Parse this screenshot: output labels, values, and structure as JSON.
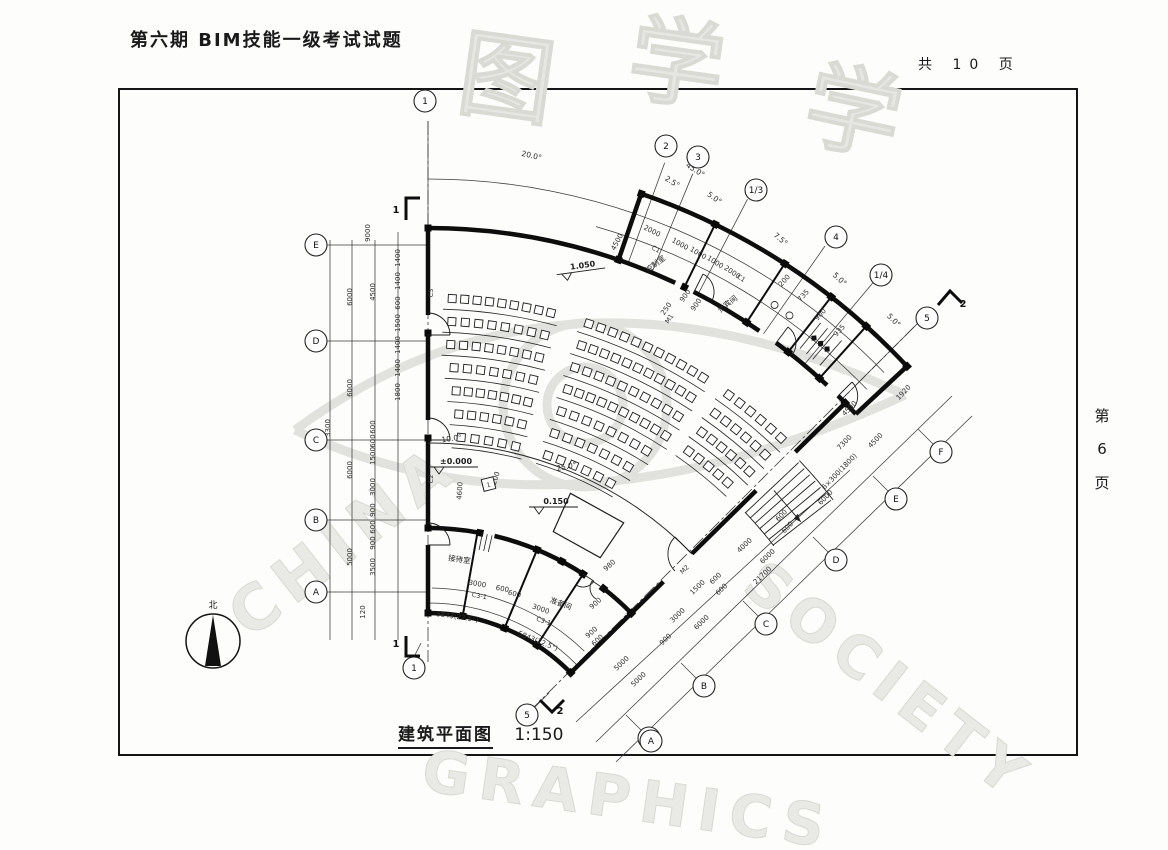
{
  "page": {
    "title": "第六期 BIM技能一级考试试题",
    "total_pages": "共 10 页",
    "side_page": [
      "第",
      "6",
      "页"
    ],
    "caption": "建筑平面图",
    "scale": "1:150"
  },
  "compass": {
    "label": "北"
  },
  "watermark": {
    "cn": [
      "图",
      "学",
      "学"
    ],
    "en": [
      "CHINA",
      "GRAPHICS",
      "SOCIETY"
    ]
  },
  "plan": {
    "axis_bubbles": [
      {
        "t": "1",
        "x": 425,
        "y": 101
      },
      {
        "t": "2",
        "x": 666,
        "y": 146
      },
      {
        "t": "3",
        "x": 698,
        "y": 157
      },
      {
        "t": "1/3",
        "x": 756,
        "y": 190
      },
      {
        "t": "4",
        "x": 836,
        "y": 237
      },
      {
        "t": "1/4",
        "x": 881,
        "y": 275
      },
      {
        "t": "5",
        "x": 927,
        "y": 318
      },
      {
        "t": "E",
        "x": 316,
        "y": 245
      },
      {
        "t": "D",
        "x": 316,
        "y": 341
      },
      {
        "t": "C",
        "x": 316,
        "y": 440
      },
      {
        "t": "B",
        "x": 316,
        "y": 520
      },
      {
        "t": "A",
        "x": 316,
        "y": 592
      },
      {
        "t": "F",
        "x": 941,
        "y": 452
      },
      {
        "t": "E",
        "x": 896,
        "y": 499
      },
      {
        "t": "D",
        "x": 836,
        "y": 560
      },
      {
        "t": "C",
        "x": 766,
        "y": 624
      },
      {
        "t": "B",
        "x": 704,
        "y": 686
      },
      {
        "t": "A",
        "x": 649,
        "y": 738
      },
      {
        "t": "5",
        "x": 527,
        "y": 715
      },
      {
        "t": "1",
        "x": 414,
        "y": 668
      },
      {
        "t": "A",
        "x": 651,
        "y": 741
      }
    ],
    "angle_dims": [
      {
        "t": "20.0°",
        "x": 531,
        "y": 158,
        "r": 13
      },
      {
        "t": "2.5°",
        "x": 671,
        "y": 184,
        "r": 32
      },
      {
        "t": "45.0°",
        "x": 694,
        "y": 172,
        "r": 33
      },
      {
        "t": "5.0°",
        "x": 713,
        "y": 200,
        "r": 35
      },
      {
        "t": "7.5°",
        "x": 779,
        "y": 241,
        "r": 40
      },
      {
        "t": "5.0°",
        "x": 838,
        "y": 281,
        "r": 43
      },
      {
        "t": "5.0°",
        "x": 892,
        "y": 322,
        "r": 45
      },
      {
        "t": "10.0°",
        "x": 452,
        "y": 441,
        "r": -8
      },
      {
        "t": "25.0°",
        "x": 567,
        "y": 469,
        "r": -12
      }
    ],
    "dim_labels": [
      {
        "t": "9000",
        "x": 370,
        "y": 233,
        "r": -90
      },
      {
        "t": "6000",
        "x": 352,
        "y": 297,
        "r": -90
      },
      {
        "t": "4500",
        "x": 375,
        "y": 292,
        "r": -90
      },
      {
        "t": "1400",
        "x": 400,
        "y": 258,
        "r": -90
      },
      {
        "t": "1400",
        "x": 400,
        "y": 281,
        "r": -90
      },
      {
        "t": "600",
        "x": 400,
        "y": 303,
        "r": -90
      },
      {
        "t": "1500",
        "x": 400,
        "y": 323,
        "r": -90
      },
      {
        "t": "1400",
        "x": 400,
        "y": 345,
        "r": -90
      },
      {
        "t": "1400",
        "x": 400,
        "y": 368,
        "r": -90
      },
      {
        "t": "6000",
        "x": 352,
        "y": 388,
        "r": -90
      },
      {
        "t": "1800",
        "x": 400,
        "y": 392,
        "r": -90
      },
      {
        "t": "3300",
        "x": 330,
        "y": 428,
        "r": -90
      },
      {
        "t": "600",
        "x": 375,
        "y": 427,
        "r": -90
      },
      {
        "t": "600",
        "x": 375,
        "y": 441,
        "r": -90
      },
      {
        "t": "1500",
        "x": 375,
        "y": 456,
        "r": -90
      },
      {
        "t": "6000",
        "x": 352,
        "y": 470,
        "r": -90
      },
      {
        "t": "3000",
        "x": 375,
        "y": 487,
        "r": -90
      },
      {
        "t": "900",
        "x": 375,
        "y": 510,
        "r": -90
      },
      {
        "t": "600",
        "x": 375,
        "y": 527,
        "r": -90
      },
      {
        "t": "900",
        "x": 375,
        "y": 543,
        "r": -90
      },
      {
        "t": "5000",
        "x": 352,
        "y": 557,
        "r": -90
      },
      {
        "t": "3500",
        "x": 375,
        "y": 567,
        "r": -90
      },
      {
        "t": "120",
        "x": 365,
        "y": 612,
        "r": -90
      },
      {
        "t": "2000",
        "x": 651,
        "y": 233,
        "r": 27
      },
      {
        "t": "1000",
        "x": 679,
        "y": 246,
        "r": 29
      },
      {
        "t": "1000",
        "x": 697,
        "y": 255,
        "r": 31
      },
      {
        "t": "1000",
        "x": 714,
        "y": 264,
        "r": 32
      },
      {
        "t": "2000",
        "x": 731,
        "y": 274,
        "r": 34
      },
      {
        "t": "4500",
        "x": 619,
        "y": 243,
        "r": -62
      },
      {
        "t": "250",
        "x": 668,
        "y": 310,
        "r": -55
      },
      {
        "t": "900",
        "x": 687,
        "y": 297,
        "r": -55
      },
      {
        "t": "900",
        "x": 698,
        "y": 306,
        "r": -55
      },
      {
        "t": "200",
        "x": 786,
        "y": 282,
        "r": -48
      },
      {
        "t": "735",
        "x": 805,
        "y": 297,
        "r": -48
      },
      {
        "t": "900",
        "x": 822,
        "y": 316,
        "r": -48
      },
      {
        "t": "935",
        "x": 841,
        "y": 332,
        "r": -48
      },
      {
        "t": "1920",
        "x": 905,
        "y": 394,
        "r": -46
      },
      {
        "t": "4500",
        "x": 851,
        "y": 410,
        "r": -46
      },
      {
        "t": "7300",
        "x": 846,
        "y": 444,
        "r": -46
      },
      {
        "t": "4500",
        "x": 877,
        "y": 442,
        "r": -46
      },
      {
        "t": "6×300(1800)",
        "x": 841,
        "y": 473,
        "r": -46
      },
      {
        "t": "6000",
        "x": 827,
        "y": 499,
        "r": -46
      },
      {
        "t": "600",
        "x": 783,
        "y": 517,
        "r": -46
      },
      {
        "t": "600",
        "x": 789,
        "y": 529,
        "r": -46
      },
      {
        "t": "1500",
        "x": 699,
        "y": 589,
        "r": -44
      },
      {
        "t": "600",
        "x": 717,
        "y": 580,
        "r": -44
      },
      {
        "t": "600",
        "x": 723,
        "y": 591,
        "r": -44
      },
      {
        "t": "4000",
        "x": 746,
        "y": 547,
        "r": -44
      },
      {
        "t": "6000",
        "x": 769,
        "y": 558,
        "r": -44
      },
      {
        "t": "21700",
        "x": 764,
        "y": 577,
        "r": -44
      },
      {
        "t": "900",
        "x": 667,
        "y": 641,
        "r": -44
      },
      {
        "t": "3000",
        "x": 679,
        "y": 617,
        "r": -44
      },
      {
        "t": "6000",
        "x": 703,
        "y": 624,
        "r": -44
      },
      {
        "t": "5000",
        "x": 623,
        "y": 665,
        "r": -44
      },
      {
        "t": "5000",
        "x": 640,
        "y": 681,
        "r": -44
      },
      {
        "t": "980",
        "x": 611,
        "y": 567,
        "r": -42
      },
      {
        "t": "900",
        "x": 593,
        "y": 634,
        "r": -42
      },
      {
        "t": "600",
        "x": 599,
        "y": 642,
        "r": -42
      },
      {
        "t": "900",
        "x": 597,
        "y": 605,
        "r": -42
      },
      {
        "t": "3000",
        "x": 477,
        "y": 586,
        "r": 9
      },
      {
        "t": "600",
        "x": 502,
        "y": 591,
        "r": 11
      },
      {
        "t": "600",
        "x": 514,
        "y": 596,
        "r": 13
      },
      {
        "t": "3000",
        "x": 540,
        "y": 611,
        "r": 19
      },
      {
        "t": "5843(22.5°)",
        "x": 457,
        "y": 619,
        "r": 8
      },
      {
        "t": "5843(22.5°)",
        "x": 537,
        "y": 643,
        "r": 22
      },
      {
        "t": "8200",
        "x": 497,
        "y": 481,
        "r": -72
      },
      {
        "t": "4600",
        "x": 462,
        "y": 491,
        "r": -86
      }
    ],
    "elevations": [
      {
        "t": "1.050",
        "x": 583,
        "y": 268,
        "r": -8
      },
      {
        "t": "±0.000",
        "x": 456,
        "y": 464,
        "r": 0
      },
      {
        "t": "0.150",
        "x": 556,
        "y": 504,
        "r": 0
      }
    ],
    "room_labels": [
      {
        "t": "控制室",
        "x": 657,
        "y": 266,
        "r": -38
      },
      {
        "t": "贵宾间",
        "x": 729,
        "y": 306,
        "r": -38
      },
      {
        "t": "接待室",
        "x": 459,
        "y": 562,
        "r": 8
      },
      {
        "t": "准备间",
        "x": 560,
        "y": 606,
        "r": 20
      }
    ],
    "tags": [
      {
        "t": "C1",
        "x": 655,
        "y": 251,
        "r": 28
      },
      {
        "t": "C1",
        "x": 740,
        "y": 280,
        "r": 33
      },
      {
        "t": "M1",
        "x": 671,
        "y": 320,
        "r": -55
      },
      {
        "t": "C3",
        "x": 433,
        "y": 293,
        "r": -90
      },
      {
        "t": "C2",
        "x": 433,
        "y": 479,
        "r": -90
      },
      {
        "t": "M2",
        "x": 686,
        "y": 571,
        "r": -44
      },
      {
        "t": "C3-1",
        "x": 479,
        "y": 598,
        "r": 10
      },
      {
        "t": "C3-1",
        "x": 543,
        "y": 623,
        "r": 20
      }
    ],
    "note_box": {
      "t": "1",
      "x": 489,
      "y": 486
    },
    "section_labels": [
      {
        "t": "1",
        "x": 396,
        "y": 213
      },
      {
        "t": "1",
        "x": 396,
        "y": 647
      },
      {
        "t": "2",
        "x": 963,
        "y": 307
      },
      {
        "t": "2",
        "x": 560,
        "y": 714
      }
    ]
  }
}
